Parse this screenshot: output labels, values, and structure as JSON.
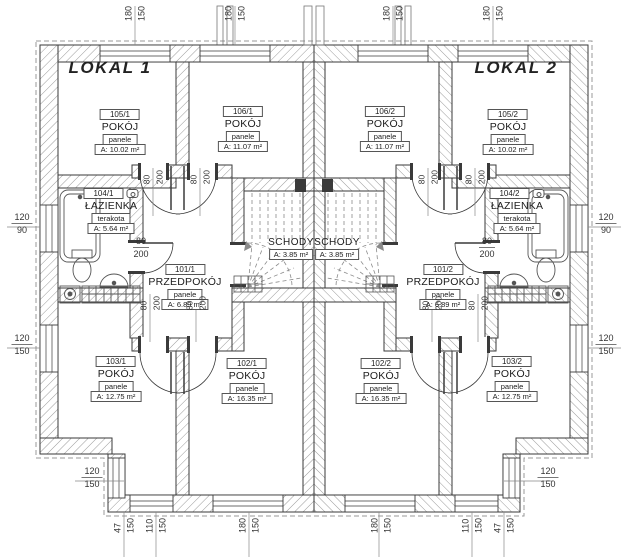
{
  "units": [
    {
      "id": "lokal-1",
      "label": "LOKAL 1"
    },
    {
      "id": "lokal-2",
      "label": "LOKAL 2"
    }
  ],
  "rooms": [
    {
      "id": "105-1",
      "number": "105/1",
      "name": "POKÓJ",
      "finish": "panele",
      "area": "A: 10.02 m²"
    },
    {
      "id": "106-1",
      "number": "106/1",
      "name": "POKÓJ",
      "finish": "panele",
      "area": "A: 11.07 m²"
    },
    {
      "id": "106-2",
      "number": "106/2",
      "name": "POKÓJ",
      "finish": "panele",
      "area": "A: 11.07 m²"
    },
    {
      "id": "105-2",
      "number": "105/2",
      "name": "POKÓJ",
      "finish": "panele",
      "area": "A: 10.02 m²"
    },
    {
      "id": "104-1",
      "number": "104/1",
      "name": "ŁAZIENKA",
      "finish": "terakota",
      "area": "A: 5.64 m²",
      "icon": "wc-icon"
    },
    {
      "id": "104-2",
      "number": "104/2",
      "name": "ŁAZIENKA",
      "finish": "terakota",
      "area": "A: 5.64 m²",
      "icon": "wc-icon"
    },
    {
      "id": "101-1",
      "number": "101/1",
      "name": "PRZEDPOKÓJ",
      "finish": "panele",
      "area": "A: 6.89 m²"
    },
    {
      "id": "101-2",
      "number": "101/2",
      "name": "PRZEDPOKÓJ",
      "finish": "panele",
      "area": "A: 6.89 m²"
    },
    {
      "id": "103-1",
      "number": "103/1",
      "name": "POKÓJ",
      "finish": "panele",
      "area": "A: 12.75 m²"
    },
    {
      "id": "102-1",
      "number": "102/1",
      "name": "POKÓJ",
      "finish": "panele",
      "area": "A: 16.35 m²"
    },
    {
      "id": "102-2",
      "number": "102/2",
      "name": "POKÓJ",
      "finish": "panele",
      "area": "A: 16.35 m²"
    },
    {
      "id": "103-2",
      "number": "103/2",
      "name": "POKÓJ",
      "finish": "panele",
      "area": "A: 12.75 m²"
    }
  ],
  "stairs": [
    {
      "id": "schody-1",
      "name": "SCHODY",
      "area": "A: 3.85 m²"
    },
    {
      "id": "schody-2",
      "name": "SCHODY",
      "area": "A: 3.85 m²"
    }
  ],
  "dimensions": [
    {
      "id": "t1",
      "values": [
        "180",
        "150"
      ]
    },
    {
      "id": "t2",
      "values": [
        "180",
        "150"
      ]
    },
    {
      "id": "t3",
      "values": [
        "180",
        "150"
      ]
    },
    {
      "id": "t4",
      "values": [
        "180",
        "150"
      ]
    },
    {
      "id": "l1",
      "values": [
        "120",
        "90"
      ]
    },
    {
      "id": "l2",
      "values": [
        "120",
        "150"
      ]
    },
    {
      "id": "r1",
      "values": [
        "120",
        "90"
      ]
    },
    {
      "id": "r2",
      "values": [
        "120",
        "150"
      ]
    },
    {
      "id": "cl",
      "values": [
        "120",
        "150"
      ]
    },
    {
      "id": "cr",
      "values": [
        "120",
        "150"
      ]
    },
    {
      "id": "b1",
      "values": [
        "47",
        "150"
      ]
    },
    {
      "id": "b2",
      "values": [
        "110",
        "150"
      ]
    },
    {
      "id": "b3",
      "values": [
        "180",
        "150"
      ]
    },
    {
      "id": "b4",
      "values": [
        "180",
        "150"
      ]
    },
    {
      "id": "b5",
      "values": [
        "110",
        "150"
      ]
    },
    {
      "id": "b6",
      "values": [
        "47",
        "150"
      ]
    }
  ],
  "door_dimensions": [
    {
      "id": "d1",
      "values": [
        "80",
        "200"
      ]
    },
    {
      "id": "d2",
      "values": [
        "80",
        "200"
      ]
    },
    {
      "id": "d3",
      "values": [
        "80",
        "200"
      ]
    },
    {
      "id": "d4",
      "values": [
        "80",
        "200"
      ]
    },
    {
      "id": "d5",
      "values": [
        "80",
        "200"
      ]
    },
    {
      "id": "d6",
      "values": [
        "80",
        "200"
      ]
    },
    {
      "id": "d7",
      "values": [
        "80",
        "200"
      ]
    },
    {
      "id": "d8",
      "values": [
        "80",
        "200"
      ]
    },
    {
      "id": "d9",
      "values": [
        "80",
        "200"
      ]
    },
    {
      "id": "d10",
      "values": [
        "80",
        "200"
      ]
    }
  ],
  "colors": {
    "line": "#3a3a3a",
    "hatch": "#9a9a9a",
    "dim": "#777777",
    "flue": "#3a3a3a"
  }
}
